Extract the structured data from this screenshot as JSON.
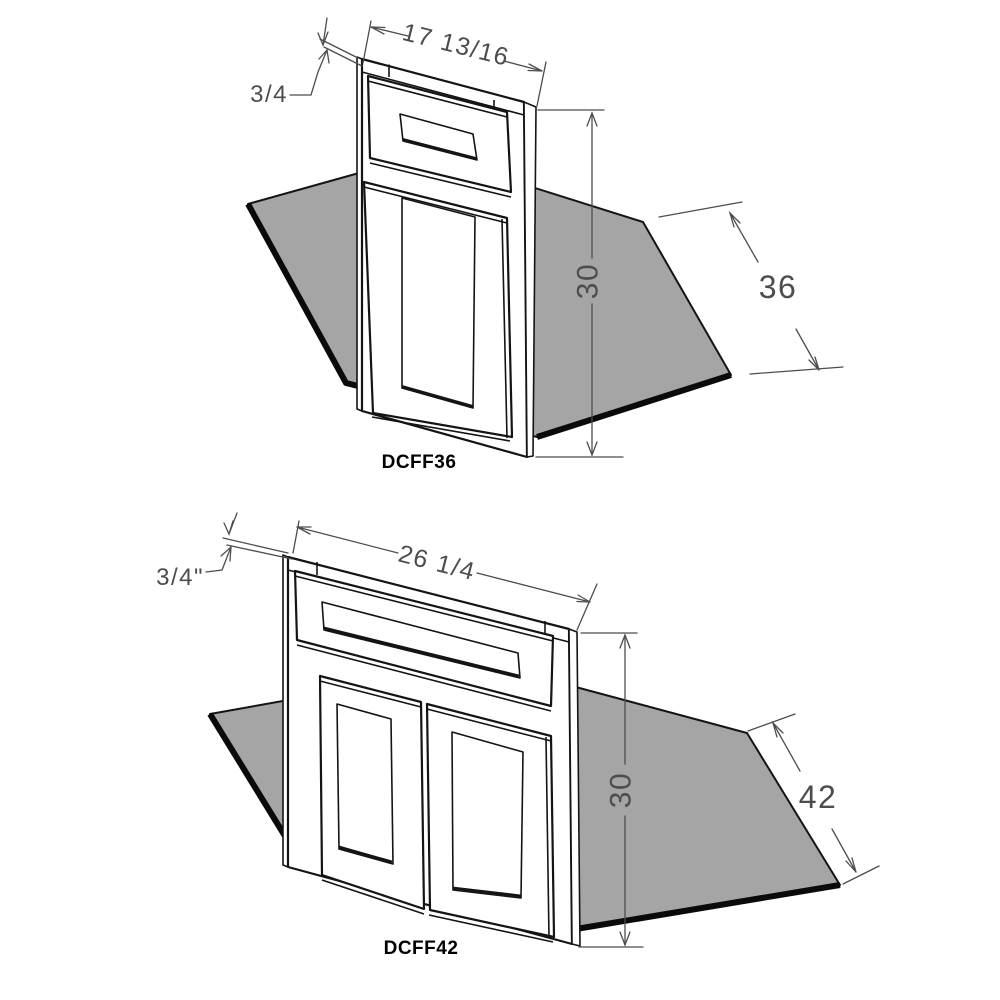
{
  "colors": {
    "background": "#ffffff",
    "plate_fill": "#a5a5a5",
    "line": "#141414",
    "dimension": "#4d4d4d",
    "label": "#000000"
  },
  "diagrams": [
    {
      "model": "DCFF36",
      "dims": {
        "thickness": "3/4",
        "width": "17 13/16",
        "height": "30",
        "depth": "36"
      }
    },
    {
      "model": "DCFF42",
      "dims": {
        "thickness": "3/4\"",
        "width": "26 1/4",
        "height": "30",
        "depth": "42"
      }
    }
  ]
}
